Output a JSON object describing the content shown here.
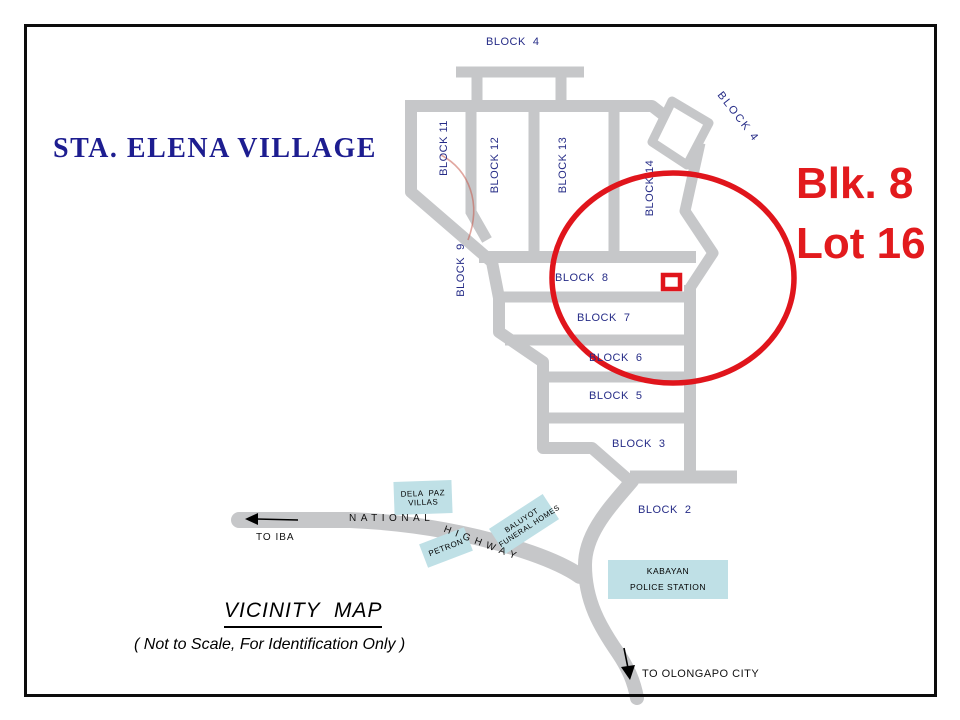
{
  "title": "STA. ELENA VILLAGE",
  "highlight": {
    "line1": "Blk. 8",
    "line2": "Lot 16"
  },
  "colors": {
    "accent_red": "#e0151c",
    "navy": "#262c87",
    "road_gray": "#c6c7c9",
    "landmark_fill": "#bfe0e6"
  },
  "blocks": {
    "b4_top": "BLOCK  4",
    "b11": "BLOCK 11",
    "b12": "BLOCK 12",
    "b13": "BLOCK 13",
    "b14": "BLOCK 14",
    "b4_rot": "BLOCK 4",
    "b9": "BLOCK  9",
    "b8": "BLOCK  8",
    "b7": "BLOCK  7",
    "b6": "BLOCK  6",
    "b5": "BLOCK  5",
    "b3": "BLOCK  3",
    "b2": "BLOCK  2"
  },
  "landmarks": {
    "dela_paz": {
      "line1": "DELA  PAZ",
      "line2": "VILLAS"
    },
    "baluyot": {
      "line1": "BALUYOT",
      "line2": "FUNERAL HOMES"
    },
    "petron": {
      "label": "PETRON"
    },
    "kabayan": {
      "line1": "KABAYAN",
      "line2": "POLICE STATION"
    }
  },
  "roads": {
    "national": "NATIONAL",
    "highway": "HIGHWAY"
  },
  "directions": {
    "to_iba": "TO IBA",
    "to_olongapo": "TO OLONGAPO CITY"
  },
  "footer": {
    "map_title": "VICINITY  MAP",
    "note": "( Not to Scale, For Identification Only )"
  }
}
